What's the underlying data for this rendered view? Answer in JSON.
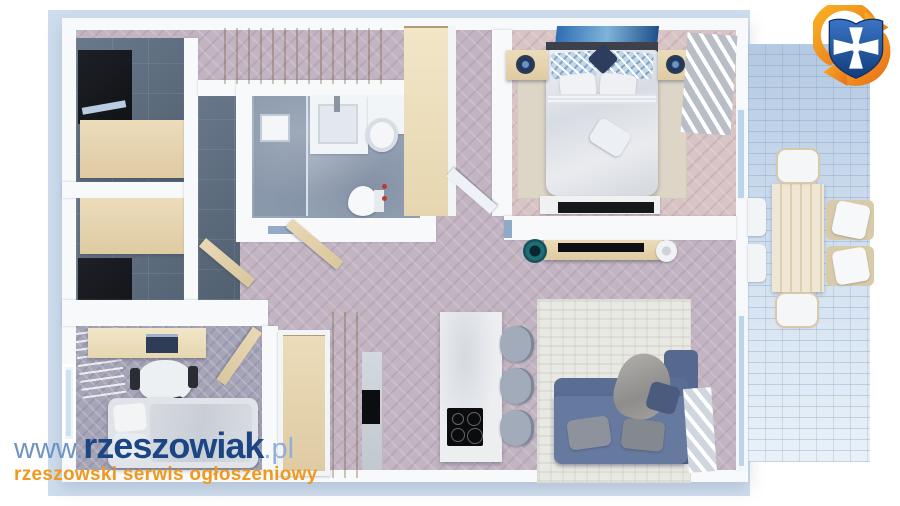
{
  "watermark": {
    "url_prefix": "www.",
    "url_name": "rzeszowiak",
    "url_suffix": ".pl",
    "tagline": "rzeszowski serwis ogłoszeniowy"
  },
  "icons": {
    "logo": "rzeszowiak-shield-refresh-logo"
  },
  "colors": {
    "brand_blue_dark": "#1c4583",
    "brand_blue_light": "#6d94c3",
    "brand_orange": "#ef991d",
    "logo_shield_blue": "#2a5cab",
    "logo_arrow_orange": "#f5941e",
    "backdrop_blue": "#cfdeee",
    "wall_white": "#f7f9fb",
    "floor_hall": "#c3b4c2",
    "floor_bedroom": "#d8c4c4",
    "floor_kids": "#a6a4b7",
    "floor_dark_tile": "#5d6b7a",
    "floor_bathroom": "#9aa6b8",
    "terrace_paving": "#bdd0e6",
    "sofa_blue": "#66799f",
    "wood": "#e4d2af"
  },
  "scene": {
    "type": "3d-floor-plan-render",
    "rooms": [
      "entry-hall-with-wardrobes",
      "wardrobe-room-top-left",
      "wardrobe-room-middle-left",
      "kids-bedroom-with-desk",
      "bathroom-with-shower-and-toilet",
      "master-bedroom-with-double-bed",
      "open-kitchen-with-island",
      "living-room-with-corner-sofa",
      "terrace-with-dining-table"
    ]
  }
}
